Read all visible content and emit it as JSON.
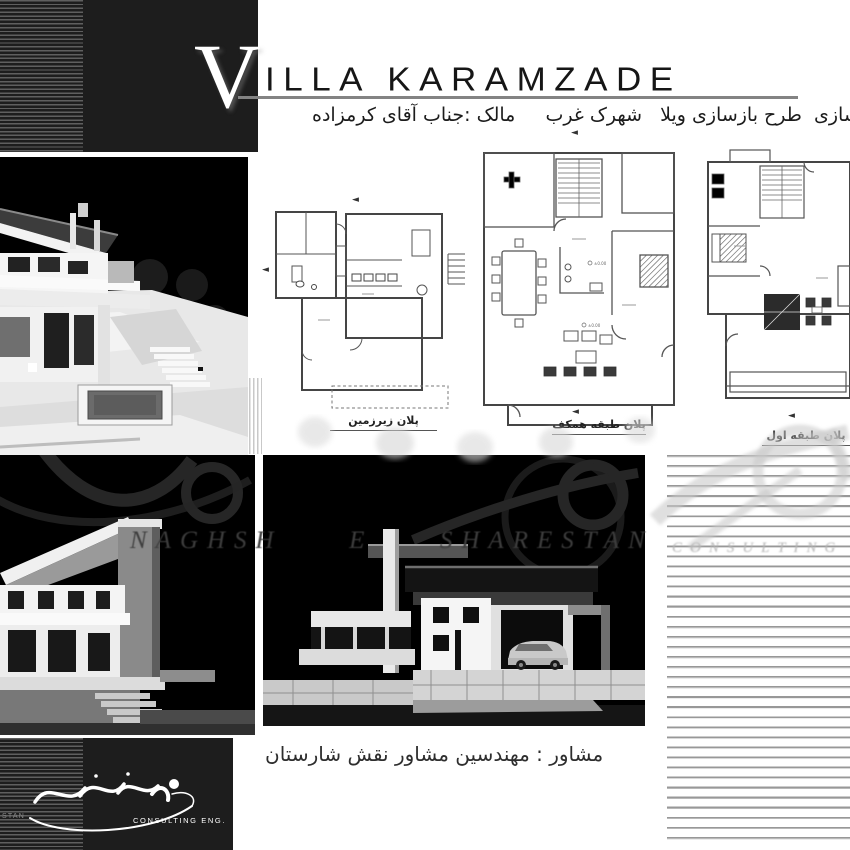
{
  "header": {
    "title_initial": "V",
    "title_rest": "ILLA KARAMZADE",
    "subtitle": "بازسازی  طرح بازسازی ویلا   شهرک غرب     مالک :جناب آقای کرمزاده"
  },
  "plans": [
    {
      "id": "basement",
      "caption": "پلان زیرزمین"
    },
    {
      "id": "ground",
      "caption": "پلان طبقه همکف"
    },
    {
      "id": "first",
      "caption": "پلان طبقه اول"
    }
  ],
  "plan_markers": {
    "level": "±0.00"
  },
  "glyphs": {
    "section_arrow": "◄"
  },
  "footer": {
    "consultant": "مشاور : مهندسین مشاور نقش شارستان"
  },
  "watermark": {
    "latin": "NAGHSH  E  SHARESTAN",
    "consulting": "CONSULTING",
    "logo_text": "CONSULTING ENG.",
    "logo_fragment": "STAN"
  },
  "colors": {
    "panel": "#1d1d1d",
    "stripe": "#5f5f5f",
    "title_rule": "#838383",
    "ruled_line": "#989898",
    "watermark_light": "#c9c9c9",
    "watermark_dark": "#3d3d3d",
    "render_bg": "#000000"
  }
}
